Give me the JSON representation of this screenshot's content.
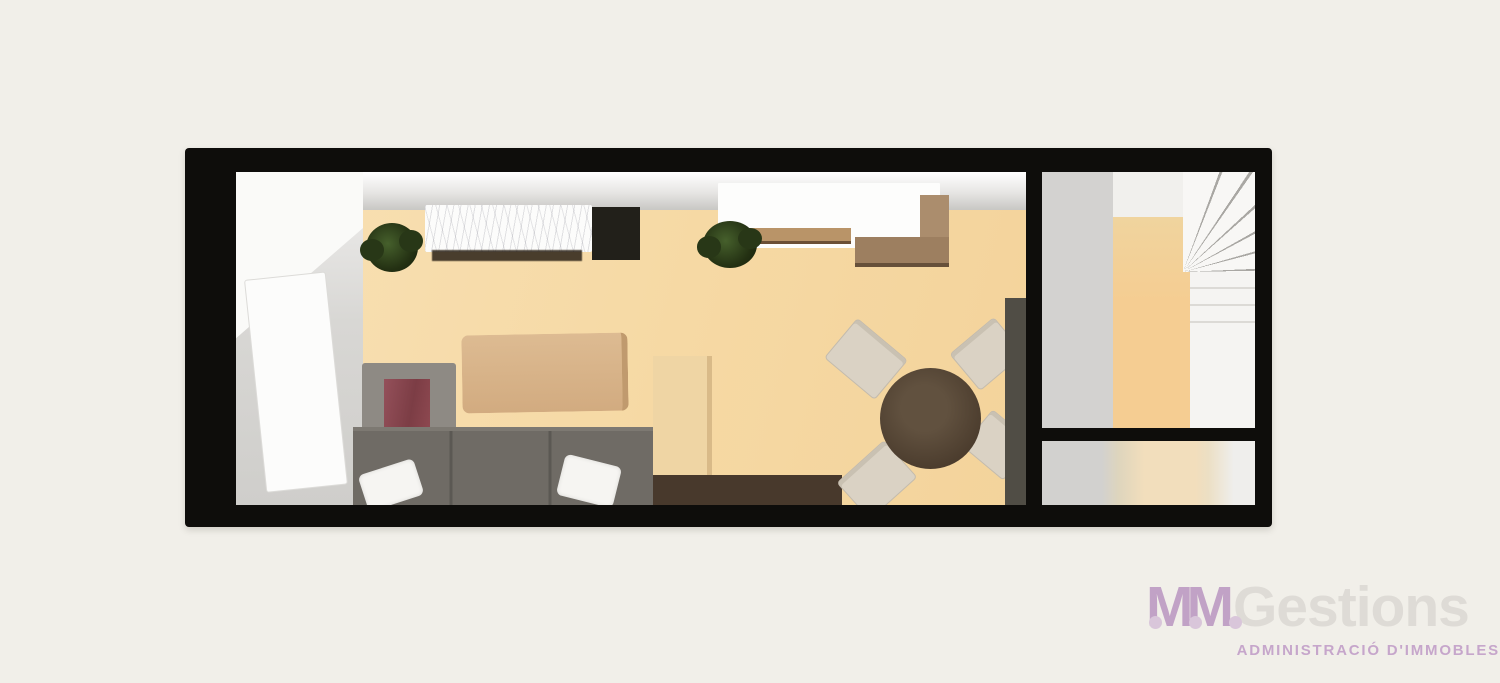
{
  "background_color": "#f1efe9",
  "logo": {
    "monogram": "MM",
    "brand": "Gestions",
    "tagline": "ADMINISTRACIÓ D'IMMOBLES",
    "monogram_color": "#c1a2c6",
    "brand_color": "#dedbd6",
    "tagline_color": "#c6a6cb"
  },
  "floorplan": {
    "type": "3d-top-down-apartment-render",
    "wall_color": "#0e0d0b",
    "rooms": [
      {
        "name": "living-dining-kitchen",
        "floor_color": "#f6d9a4"
      },
      {
        "name": "entry-hall",
        "floor_color": "#d6d5d2"
      },
      {
        "name": "stair-room",
        "floor_color": "#d3d2d0",
        "feature": "winder-staircase"
      },
      {
        "name": "lower-right-room",
        "floor_color": "#ecdcba"
      }
    ],
    "furniture": [
      {
        "name": "white-door-open",
        "color": "#fcfcfb"
      },
      {
        "name": "marble-kitchen-counter",
        "color": "#fcfcfb"
      },
      {
        "name": "dark-cabinet-block",
        "color": "#22201a"
      },
      {
        "name": "white-kitchen-counter",
        "color": "#fdfdfc"
      },
      {
        "name": "wood-wall-shelf",
        "color": "#b99468"
      },
      {
        "name": "wood-corner-unit",
        "color": "#ab8d6d"
      },
      {
        "name": "potted-plant",
        "color": "#283717"
      },
      {
        "name": "potted-plant",
        "color": "#283717"
      },
      {
        "name": "wood-coffee-table",
        "color": "#d2ab80"
      },
      {
        "name": "armchair-with-red-cushion",
        "color": "#8e8a84",
        "cushion_color": "#8d4850"
      },
      {
        "name": "gray-sofa",
        "color": "#6f6b65"
      },
      {
        "name": "white-pillow",
        "color": "#f6f5f2"
      },
      {
        "name": "white-pillow",
        "color": "#f6f5f2"
      },
      {
        "name": "tan-side-cabinet",
        "color": "#efd5a4"
      },
      {
        "name": "dark-sideboard",
        "color": "#48392c"
      },
      {
        "name": "round-dining-table",
        "color": "#4c3d2e"
      },
      {
        "name": "dining-chair",
        "color": "#dad2c4"
      },
      {
        "name": "dining-chair",
        "color": "#dad2c4"
      },
      {
        "name": "dining-chair",
        "color": "#dad2c4"
      },
      {
        "name": "dining-chair",
        "color": "#dad2c4"
      },
      {
        "name": "tall-cabinet",
        "color": "#504d45"
      }
    ]
  }
}
